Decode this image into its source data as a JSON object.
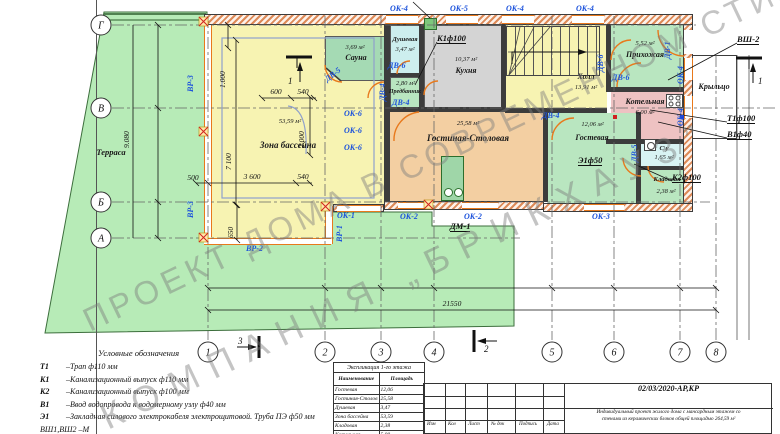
{
  "watermark": {
    "line1": "ПРОЕКТ ДОМА В СОВРЕМЕННОМ СТИЛЕ",
    "line2": "КОМПАНИЯ „БРИКХАУЗ”"
  },
  "rooms": {
    "terrace": {
      "name": "Терраса"
    },
    "pool": {
      "name": "Зона бассейна",
      "area": "53,59 м²"
    },
    "sauna": {
      "name": "Сауна",
      "area": "3,69 м²"
    },
    "shower": {
      "name": "Душевая",
      "area": "3,47 м²"
    },
    "anteroom": {
      "name": "Предбанник",
      "area": "2,80 м²"
    },
    "kitchen": {
      "name": "Кухня",
      "area": "10,37 м²"
    },
    "hall": {
      "name": "Холл",
      "area": "13,91 м²"
    },
    "entry": {
      "name": "Прихожая",
      "area": "5,52 м²"
    },
    "boiler": {
      "name": "Котельная",
      "area": "6,00 м²"
    },
    "living": {
      "name": "Гостиная-Столовая",
      "area": "25,58 м²"
    },
    "guest": {
      "name": "Гостевая",
      "area": "12,06 м²"
    },
    "wc": {
      "name": "С\\у",
      "area": "1,65 м²"
    },
    "storage": {
      "name": "Кладовая",
      "area": "2,38 м²"
    },
    "porch": {
      "name": "Крыльцо"
    }
  },
  "openings": {
    "ok1": "ОК-1",
    "ok2": "ОК-2",
    "ok3": "ОК-3",
    "ok4": "ОК-4",
    "ok5": "ОК-5",
    "ok6": "ОК-6",
    "dv1": "ДВ-1",
    "dv4": "ДВ-4",
    "dv5": "ДВ-5",
    "dv6": "ДВ-6",
    "vr1": "ВР-1",
    "vr2": "ВР-2",
    "vr3": "ВР-3",
    "dm1": "ДМ-1"
  },
  "utilities": {
    "k1": "К1ф100",
    "k2": "К2ф100",
    "t1": "Т1ф100",
    "v1": "В1ф40",
    "e1": "Э1ф50",
    "vsh2": "ВШ-2"
  },
  "dims": {
    "v9080": "9.080",
    "v1000": "1.000",
    "v7100": "7 100",
    "v2000": "2.000",
    "h600": "600",
    "h540": "540",
    "h500": "500",
    "h3600": "3 600",
    "v650": "650",
    "total": "21550"
  },
  "grid": {
    "rows": [
      "Г",
      "В",
      "Б",
      "А"
    ],
    "cols": [
      "1",
      "2",
      "3",
      "4",
      "5",
      "6",
      "7",
      "8"
    ]
  },
  "sections": {
    "s1": "1",
    "s2": "2",
    "s3": "3"
  },
  "legend": {
    "title": "Условные обозначения",
    "items": [
      {
        "code": "Т1",
        "text": "–Трап ф110 мм"
      },
      {
        "code": "К1",
        "text": "–Канализационный выпуск ф110 мм"
      },
      {
        "code": "К2",
        "text": "–Канализационный выпуск ф100 мм"
      },
      {
        "code": "В1",
        "text": "–Ввод водопровода к водомерному узлу ф40 мм"
      },
      {
        "code": "Э1",
        "text": "–Закладная силового электрокабеля электрощитовой. Труба ПЭ ф50 мм"
      }
    ],
    "clipped": "ВШ1,ВШ2 –М"
  },
  "explication": {
    "title": "Экспликация 1-го этажа",
    "col_name": "Наименование",
    "col_area": "Площадь",
    "rows": [
      [
        "Гостевая",
        "12,06"
      ],
      [
        "Гостиная-Столов",
        "25,58"
      ],
      [
        "Душевая",
        "3,47"
      ],
      [
        "Зона бассейна",
        "53,59"
      ],
      [
        "Кладовая",
        "2,38"
      ],
      [
        "Котельная",
        "5,00"
      ]
    ]
  },
  "titleblock": {
    "cols": [
      "Изм",
      "Кол",
      "Лист",
      "№ док",
      "Подпись",
      "Дата"
    ],
    "doc": "02/03/2020-АР,КР",
    "desc1": "Индивидуальный проект жилого дома с мансардным этажем со",
    "desc2": "стенами из керамических блоков общей площадью 264,59 м²"
  }
}
